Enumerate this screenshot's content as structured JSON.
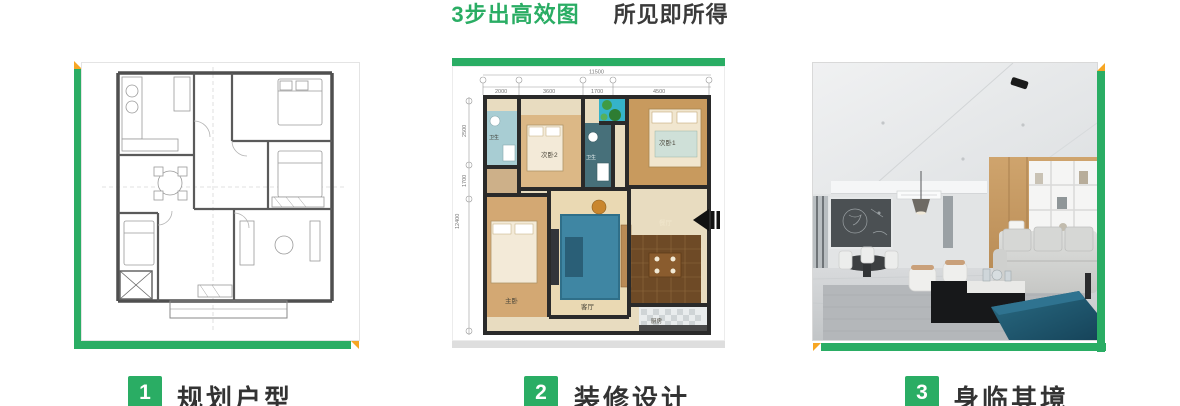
{
  "title": {
    "highlight": "3步出高效图",
    "tagline": "所见即所得"
  },
  "steps": [
    {
      "number": "1",
      "label": "规划户型"
    },
    {
      "number": "2",
      "label": "装修设计"
    },
    {
      "number": "3",
      "label": "身临其境"
    }
  ],
  "colors": {
    "accent_green": "#2aad64",
    "accent_orange": "#f7a623",
    "title_green": "#2aad64",
    "text_dark": "#333333"
  },
  "colored_plan": {
    "top_dims": [
      "2000",
      "3600",
      "1700",
      "4500"
    ],
    "top_total": "11500",
    "left_dims": [
      "2500",
      "1700"
    ],
    "left_total": "12400",
    "rooms": {
      "bedroom2": "次卧2",
      "bedroom1": "次卧1",
      "master": "主卧",
      "living": "客厅",
      "dining": "餐厅",
      "kitchen": "厨房",
      "bath": "卫生"
    }
  }
}
